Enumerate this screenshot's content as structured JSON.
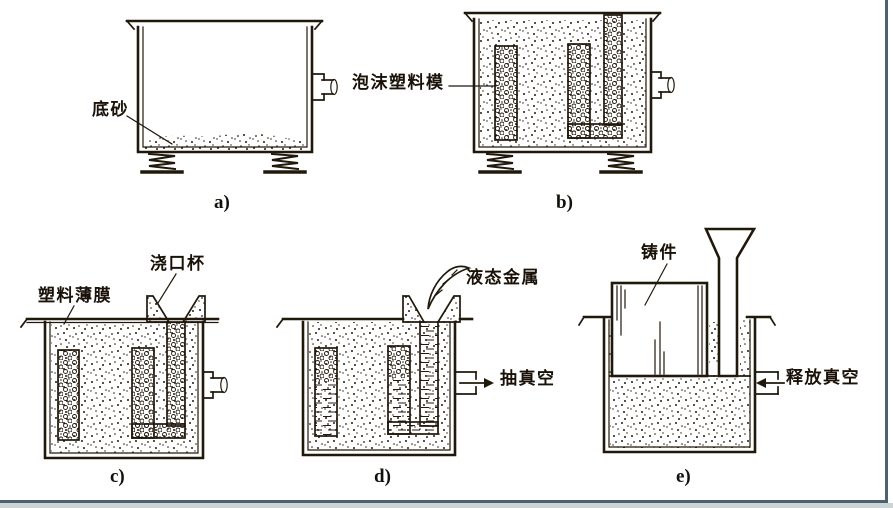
{
  "figure": {
    "panels": {
      "a": {
        "caption": "a)",
        "labels": {
          "bottom_sand": "底砂"
        }
      },
      "b": {
        "caption": "b)",
        "labels": {
          "foam_pattern": "泡沫塑料模"
        }
      },
      "c": {
        "caption": "c)",
        "labels": {
          "plastic_film": "塑料薄膜",
          "pouring_cup": "浇口杯"
        }
      },
      "d": {
        "caption": "d)",
        "labels": {
          "liquid_metal": "液态金属",
          "draw_vacuum": "抽真空"
        }
      },
      "e": {
        "caption": "e)",
        "labels": {
          "casting": "铸件",
          "release_vacuum": "释放真空"
        }
      }
    },
    "icons": {
      "draw_vacuum_arrow": "→",
      "release_vacuum_arrow": "←"
    },
    "colors": {
      "ink": "#21180c",
      "slide_border": "#4d6271",
      "background": "#ffffff"
    }
  }
}
